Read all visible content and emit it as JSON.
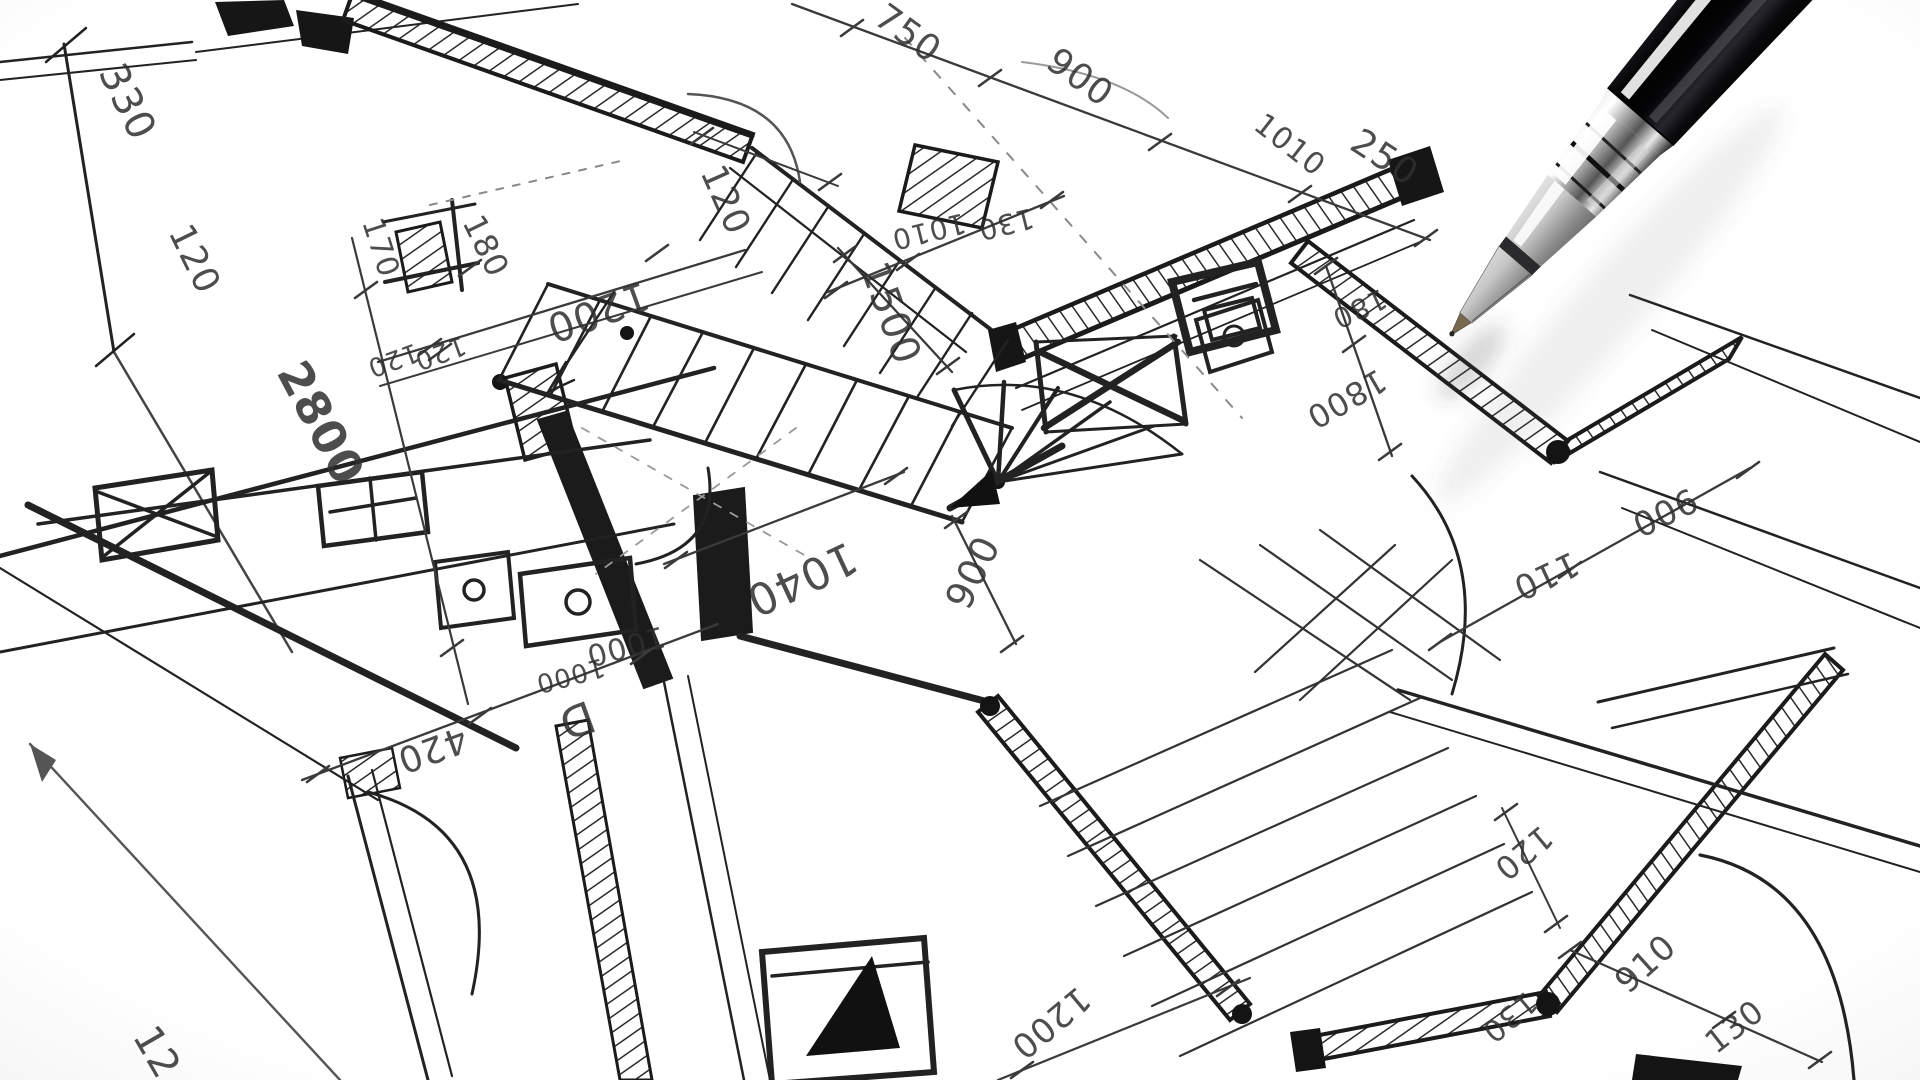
{
  "colors": {
    "paper": "#ffffff",
    "ink": "#1f1f1f",
    "pencil_gray": "#8a8a8a",
    "pen_barrel_black": "#0a0a0c",
    "pen_chrome": "#d6d6d6",
    "pen_tip_brass": "#77684e"
  },
  "icons": {
    "pen": "ballpoint-pen"
  },
  "labels": [
    {
      "text": "330",
      "x": 98,
      "y": 72,
      "rot": 64,
      "size": 40
    },
    {
      "text": "120",
      "x": 168,
      "y": 232,
      "rot": 64,
      "size": 36
    },
    {
      "text": "170",
      "x": 362,
      "y": 222,
      "rot": 72,
      "size": 30
    },
    {
      "text": "180",
      "x": 462,
      "y": 222,
      "rot": 64,
      "size": 32
    },
    {
      "text": "1200",
      "x": 643,
      "y": 281,
      "rot": 160,
      "size": 40
    },
    {
      "text": "120",
      "x": 415,
      "y": 343,
      "rot": 160,
      "size": 26
    },
    {
      "text": "120",
      "x": 462,
      "y": 336,
      "rot": 160,
      "size": 26
    },
    {
      "text": "2800",
      "x": 276,
      "y": 372,
      "rot": 62,
      "size": 46,
      "bold": true
    },
    {
      "text": "750",
      "x": 872,
      "y": 22,
      "rot": 36,
      "size": 36
    },
    {
      "text": "900",
      "x": 1044,
      "y": 66,
      "rot": 36,
      "size": 36
    },
    {
      "text": "1010",
      "x": 1252,
      "y": 128,
      "rot": 38,
      "size": 30
    },
    {
      "text": "250",
      "x": 1348,
      "y": 148,
      "rot": 33,
      "size": 36
    },
    {
      "text": "120",
      "x": 700,
      "y": 172,
      "rot": 66,
      "size": 36
    },
    {
      "text": "1500",
      "x": 860,
      "y": 268,
      "rot": 70,
      "size": 40
    },
    {
      "text": "1010",
      "x": 963,
      "y": 213,
      "rot": 166,
      "size": 28
    },
    {
      "text": "130",
      "x": 1031,
      "y": 208,
      "rot": 166,
      "size": 28
    },
    {
      "text": "180",
      "x": 1381,
      "y": 288,
      "rot": 155,
      "size": 28
    },
    {
      "text": "1800",
      "x": 1378,
      "y": 368,
      "rot": 150,
      "size": 32
    },
    {
      "text": "1040",
      "x": 848,
      "y": 541,
      "rot": 155,
      "size": 44
    },
    {
      "text": "900",
      "x": 968,
      "y": 612,
      "rot": 296,
      "size": 38
    },
    {
      "text": "1000",
      "x": 662,
      "y": 626,
      "rot": 165,
      "size": 30
    },
    {
      "text": "1000",
      "x": 602,
      "y": 658,
      "rot": 165,
      "size": 26
    },
    {
      "text": "420",
      "x": 462,
      "y": 726,
      "rot": 160,
      "size": 36
    },
    {
      "text": "D",
      "x": 588,
      "y": 700,
      "rot": 160,
      "size": 44
    },
    {
      "text": "900",
      "x": 1690,
      "y": 487,
      "rot": 154,
      "size": 34
    },
    {
      "text": "110",
      "x": 1572,
      "y": 551,
      "rot": 155,
      "size": 34
    },
    {
      "text": "120",
      "x": 1541,
      "y": 824,
      "rot": 140,
      "size": 32
    },
    {
      "text": "910",
      "x": 1628,
      "y": 995,
      "rot": 318,
      "size": 34
    },
    {
      "text": "130",
      "x": 1716,
      "y": 1055,
      "rot": 322,
      "size": 32
    },
    {
      "text": "130",
      "x": 1526,
      "y": 990,
      "rot": 140,
      "size": 30
    },
    {
      "text": "1200",
      "x": 1078,
      "y": 985,
      "rot": 140,
      "size": 34
    },
    {
      "text": "12",
      "x": 132,
      "y": 1036,
      "rot": 60,
      "size": 40
    }
  ]
}
